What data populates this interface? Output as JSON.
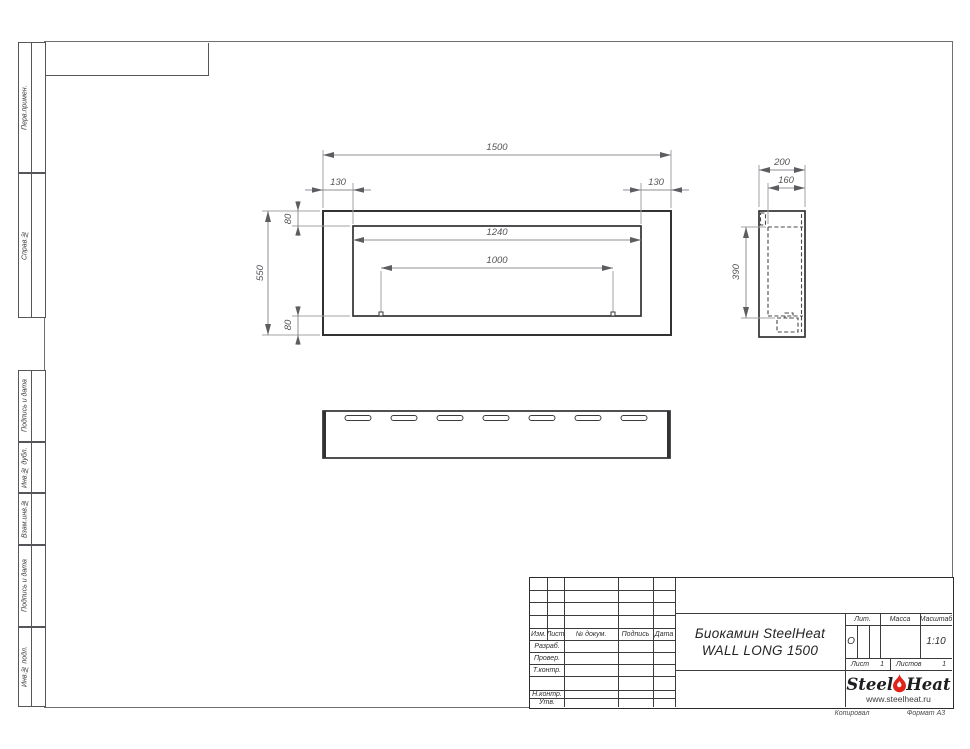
{
  "sheet": {
    "footer": {
      "copy_label": "Копировал",
      "format_label": "Формат А3"
    }
  },
  "margin_columns": {
    "top": [
      {
        "label": "Перв.примен."
      },
      {
        "label": "Справ.№"
      }
    ],
    "bottom": [
      {
        "label": "Подпись и дата"
      },
      {
        "label": "Инв.№ дубл."
      },
      {
        "label": "Взам.инв.№"
      },
      {
        "label": "Подпись и дата"
      },
      {
        "label": "Инв.№ подл."
      }
    ]
  },
  "views": {
    "front_view": {
      "dim_overall_width": "1500",
      "dim_left_offset": "130",
      "dim_right_offset": "130",
      "dim_top_offset": "80",
      "dim_opening_width": "1240",
      "dim_burner_width": "1000",
      "dim_overall_height": "550",
      "dim_bottom_offset": "80"
    },
    "side_view": {
      "dim_depth": "200",
      "dim_inner_depth": "160",
      "dim_height": "390"
    },
    "bottom_view": {
      "vent_slot_count": 7
    }
  },
  "title_block": {
    "header_cols": [
      "Изм.",
      "Лист",
      "№ докум.",
      "Подпись",
      "Дата"
    ],
    "row_labels": [
      "Разраб.",
      "Провер.",
      "Т.контр.",
      "Н.контр.",
      "Утв."
    ],
    "title_line1": "Биокамин SteelHeat",
    "title_line2": "WALL LONG 1500",
    "lit_label": "Лит.",
    "lit_value": "О",
    "mass_label": "Масса",
    "scale_label": "Масштаб",
    "scale_value": "1:10",
    "sheet_label": "Лист",
    "sheet_number": "1",
    "sheets_label": "Листов",
    "sheets_total": "1",
    "logo": {
      "part1": "Steel",
      "part2": "Heat",
      "url": "www.steelheat.ru"
    }
  },
  "colors": {
    "accent_flame": "#e2231a",
    "line_dark": "#323235",
    "line_dim": "#8f8f93"
  }
}
